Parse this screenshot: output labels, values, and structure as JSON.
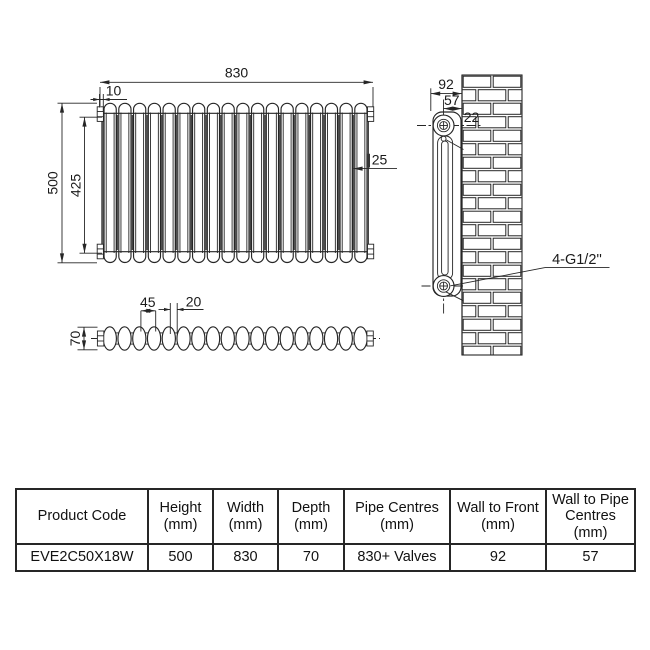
{
  "colors": {
    "line": "#262626",
    "text": "#1a1a1a",
    "background": "#ffffff"
  },
  "front_view": {
    "sections": 18,
    "labels": {
      "overall_width": "830",
      "end_cap": "10",
      "overall_height": "500",
      "vertical_pipe_centres": "425",
      "column_diameter": "∥25"
    }
  },
  "side_view": {
    "labels": {
      "wall_to_front": "92",
      "wall_to_pipe_centres": "57",
      "bracket_offset": "22",
      "pipe_connections": "4-G1/2''"
    }
  },
  "top_view": {
    "labels": {
      "section_pitch": "45",
      "section_joint": "20",
      "depth": "70"
    }
  },
  "spec_table": {
    "headers": [
      [
        "Product Code"
      ],
      [
        "Height",
        "(mm)"
      ],
      [
        "Width",
        "(mm)"
      ],
      [
        "Depth",
        "(mm)"
      ],
      [
        "Pipe Centres",
        "(mm)"
      ],
      [
        "Wall to Front",
        "(mm)"
      ],
      [
        "Wall to Pipe",
        "Centres",
        "(mm)"
      ]
    ],
    "rows": [
      [
        "EVE2C50X18W",
        "500",
        "830",
        "70",
        "830+ Valves",
        "92",
        "57"
      ]
    ]
  }
}
